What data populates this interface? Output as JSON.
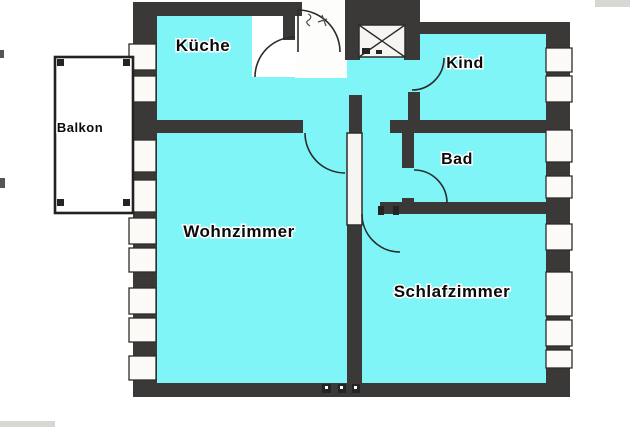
{
  "floorplan": {
    "rooms": [
      {
        "id": "kueche",
        "label": "Küche"
      },
      {
        "id": "kind",
        "label": "Kind"
      },
      {
        "id": "bad",
        "label": "Bad"
      },
      {
        "id": "wohnzimmer",
        "label": "Wohnzimmer"
      },
      {
        "id": "schlafzimmer",
        "label": "Schlafzimmer"
      },
      {
        "id": "balkon",
        "label": "Balkon"
      }
    ],
    "colors": {
      "room_fill": "#7ff5f7",
      "wall": "#3a3937",
      "background": "#ffffff"
    }
  }
}
